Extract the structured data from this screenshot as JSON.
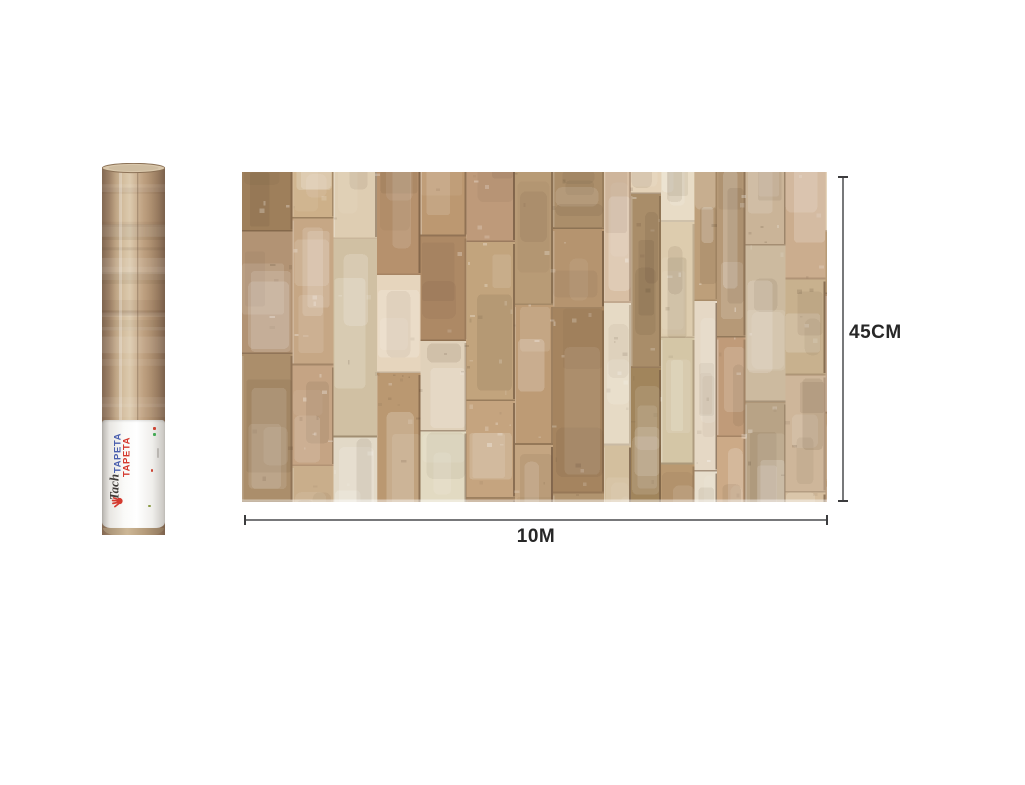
{
  "canvas": {
    "background": "#ffffff"
  },
  "roll": {
    "label": {
      "brand": "Tach",
      "word_blue": "TAPETA",
      "word_red": "TAPETA",
      "brand_color": "#3f3b38",
      "blue": "#4a5fae",
      "red": "#d43a2f",
      "icon": "hand-icon",
      "icon_color": "#d43a2f"
    }
  },
  "dimensions": {
    "height_label": "45CM",
    "width_label": "10M",
    "line_color": "#77787a",
    "cap_color": "#3c3c3e",
    "text_color": "#272727"
  },
  "texture_palette": {
    "base": [
      "#c5a885",
      "#bb9c78",
      "#cdb394",
      "#b3926d",
      "#d0bb9e",
      "#c9ae8d",
      "#ab8c68",
      "#c1a07c"
    ],
    "light": [
      "#e2d5bd",
      "#dbcbb0",
      "#d7c6aa",
      "#e6dbc6"
    ],
    "dark_seam": "#6d543c",
    "roll_gradient": [
      "#826852",
      "#9c8066",
      "#bfa585",
      "#d3bd9e",
      "#dccaae",
      "#cdb394",
      "#bd9f7f",
      "#ad8f70",
      "#977a5f",
      "#7b614c"
    ],
    "roll_top": "#d9c7ab",
    "roll_top_rim": "#8b7156"
  }
}
